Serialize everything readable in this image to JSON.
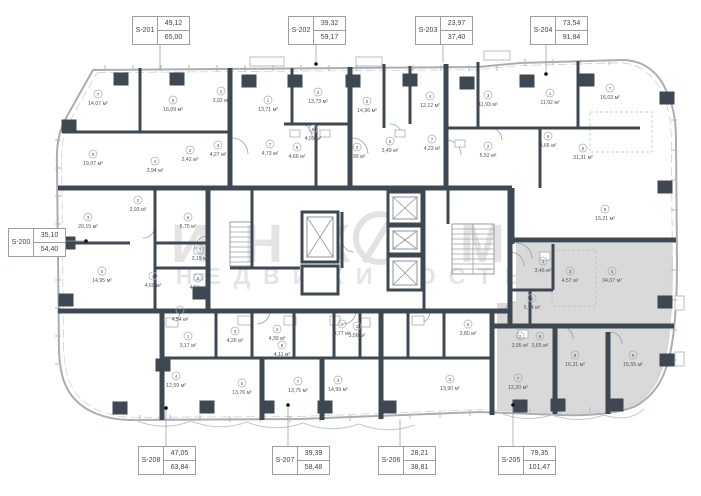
{
  "watermark": {
    "brand": "ИНКОМ",
    "tagline": "НЕДВИЖИМОСТЬ"
  },
  "selected_unit": "S-205",
  "colors": {
    "wall": "#3d4852",
    "outline": "#a9aeb4",
    "selected_fill": "#d9d9d9",
    "watermark": "#e4e4e4",
    "leader": "#8f959b"
  },
  "units": [
    {
      "id": "S-200",
      "area_living": "35,10",
      "area_total": "54,40",
      "box": [
        8,
        228
      ],
      "line": [
        [
          66,
          241
        ],
        [
          86,
          241
        ]
      ],
      "dot": [
        86,
        241
      ]
    },
    {
      "id": "S-201",
      "area_living": "49,12",
      "area_total": "65,00",
      "box": [
        132,
        16
      ],
      "line": [
        [
          160,
          43
        ],
        [
          160,
          70
        ]
      ]
    },
    {
      "id": "S-202",
      "area_living": "39,32",
      "area_total": "59,17",
      "box": [
        288,
        16
      ],
      "line": [
        [
          316,
          43
        ],
        [
          316,
          63
        ]
      ],
      "dot": [
        316,
        64
      ]
    },
    {
      "id": "S-203",
      "area_living": "23,97",
      "area_total": "37,40",
      "box": [
        415,
        16
      ],
      "line": [
        [
          443,
          43
        ],
        [
          443,
          63
        ]
      ]
    },
    {
      "id": "S-204",
      "area_living": "73,54",
      "area_total": "91,84",
      "box": [
        530,
        16
      ],
      "line": [
        [
          546,
          43
        ],
        [
          546,
          73
        ]
      ],
      "dot": [
        546,
        74
      ]
    },
    {
      "id": "S-208",
      "area_living": "47,05",
      "area_total": "63,84",
      "box": [
        138,
        446
      ],
      "line": [
        [
          166,
          446
        ],
        [
          166,
          409
        ]
      ],
      "dot": [
        166,
        408
      ]
    },
    {
      "id": "S-207",
      "area_living": "39,39",
      "area_total": "58,48",
      "box": [
        272,
        446
      ],
      "line": [
        [
          288,
          446
        ],
        [
          288,
          406
        ]
      ],
      "dot": [
        288,
        405
      ]
    },
    {
      "id": "S-206",
      "area_living": "28,21",
      "area_total": "38,81",
      "box": [
        378,
        446
      ],
      "line": [
        [
          400,
          446
        ],
        [
          400,
          419
        ]
      ]
    },
    {
      "id": "S-205",
      "area_living": "79,35",
      "area_total": "101,47",
      "box": [
        498,
        446
      ],
      "line": [
        [
          513,
          446
        ],
        [
          513,
          406
        ]
      ],
      "dot": [
        513,
        405
      ]
    }
  ],
  "rooms": [
    {
      "num": "7",
      "area": "14,07 м²",
      "x": 98,
      "y": 100
    },
    {
      "num": "5",
      "area": "16,09 м²",
      "x": 173,
      "y": 106
    },
    {
      "num": "1",
      "area": "3,93 м²",
      "x": 221,
      "y": 97
    },
    {
      "num": "6",
      "area": "19,07 м²",
      "x": 93,
      "y": 160
    },
    {
      "num": "4",
      "area": "3,94 м²",
      "x": 155,
      "y": 167
    },
    {
      "num": "2",
      "area": "2,42 м²",
      "x": 190,
      "y": 156
    },
    {
      "num": "3",
      "area": "4,27 м²",
      "x": 218,
      "y": 151
    },
    {
      "num": "1",
      "area": "13,71 м²",
      "x": 268,
      "y": 106
    },
    {
      "num": "2",
      "area": "13,73 м²",
      "x": 318,
      "y": 98
    },
    {
      "num": "6",
      "area": "4,09 м²",
      "x": 313,
      "y": 135
    },
    {
      "num": "7",
      "area": "4,73 м²",
      "x": 270,
      "y": 150
    },
    {
      "num": "8",
      "area": "4,66 м²",
      "x": 297,
      "y": 153
    },
    {
      "num": "5",
      "area": "14,96 м²",
      "x": 367,
      "y": 107
    },
    {
      "num": "3",
      "area": "2,99 м²",
      "x": 357,
      "y": 153
    },
    {
      "num": "6",
      "area": "3,49 м²",
      "x": 390,
      "y": 147
    },
    {
      "num": "4",
      "area": "12,12 м²",
      "x": 430,
      "y": 102
    },
    {
      "num": "7",
      "area": "4,23 м²",
      "x": 432,
      "y": 145
    },
    {
      "num": "3",
      "area": "11,93 м²",
      "x": 488,
      "y": 101
    },
    {
      "num": "2",
      "area": "5,52 м²",
      "x": 488,
      "y": 152
    },
    {
      "num": "1",
      "area": "11,92 м²",
      "x": 550,
      "y": 99
    },
    {
      "num": "6",
      "area": "3,66 м²",
      "x": 548,
      "y": 142
    },
    {
      "num": "7",
      "area": "16,03 м²",
      "x": 610,
      "y": 94
    },
    {
      "num": "5",
      "area": "31,31 м²",
      "x": 583,
      "y": 154
    },
    {
      "num": "8",
      "area": "15,21 м²",
      "x": 605,
      "y": 215
    },
    {
      "num": "2",
      "area": "3,93 м²",
      "x": 138,
      "y": 206
    },
    {
      "num": "3",
      "area": "20,15 м²",
      "x": 88,
      "y": 223
    },
    {
      "num": "6",
      "area": "5,75 м²",
      "x": 188,
      "y": 223
    },
    {
      "num": "1",
      "area": "3,19 м²",
      "x": 200,
      "y": 255
    },
    {
      "num": "8",
      "area": "4,51 м²",
      "x": 198,
      "y": 284
    },
    {
      "num": "5",
      "area": "14,95 м²",
      "x": 102,
      "y": 277
    },
    {
      "num": "4",
      "area": "4,69 м²",
      "x": 153,
      "y": 282
    },
    {
      "num": "7",
      "area": "4,54 м²",
      "x": 180,
      "y": 316
    },
    {
      "num": "1",
      "area": "3,17 м²",
      "x": 188,
      "y": 342
    },
    {
      "num": "3",
      "area": "4,26 м²",
      "x": 235,
      "y": 337
    },
    {
      "num": "4",
      "area": "12,59 м²",
      "x": 176,
      "y": 382
    },
    {
      "num": "5",
      "area": "13,76 м²",
      "x": 242,
      "y": 389
    },
    {
      "num": "2",
      "area": "4,39 м²",
      "x": 277,
      "y": 335
    },
    {
      "num": "8",
      "area": "4,11 м²",
      "x": 282,
      "y": 351
    },
    {
      "num": "7",
      "area": "13,75 м²",
      "x": 298,
      "y": 387
    },
    {
      "num": "4",
      "area": "3,77 м²",
      "x": 342,
      "y": 330
    },
    {
      "num": "1",
      "area": "3,56 м²",
      "x": 357,
      "y": 332
    },
    {
      "num": "3",
      "area": "14,99 м²",
      "x": 338,
      "y": 386
    },
    {
      "num": "5",
      "area": "3,80 м²",
      "x": 468,
      "y": 330
    },
    {
      "num": "2",
      "area": "13,90 м²",
      "x": 450,
      "y": 385
    },
    {
      "num": "1",
      "area": "3,46 м²",
      "x": 543,
      "y": 267
    },
    {
      "num": "3",
      "area": "4,57 м²",
      "x": 570,
      "y": 277
    },
    {
      "num": "4",
      "area": "34,07 м²",
      "x": 612,
      "y": 277
    },
    {
      "num": "5",
      "area": "5,74 м²",
      "x": 532,
      "y": 304
    },
    {
      "num": "2",
      "area": "3,95 м²",
      "x": 520,
      "y": 342
    },
    {
      "num": "6",
      "area": "3,65 м²",
      "x": 540,
      "y": 342
    },
    {
      "num": "7",
      "area": "12,20 м²",
      "x": 518,
      "y": 384
    },
    {
      "num": "8",
      "area": "16,31 м²",
      "x": 575,
      "y": 361
    },
    {
      "num": "9",
      "area": "15,55 м²",
      "x": 633,
      "y": 361
    }
  ]
}
